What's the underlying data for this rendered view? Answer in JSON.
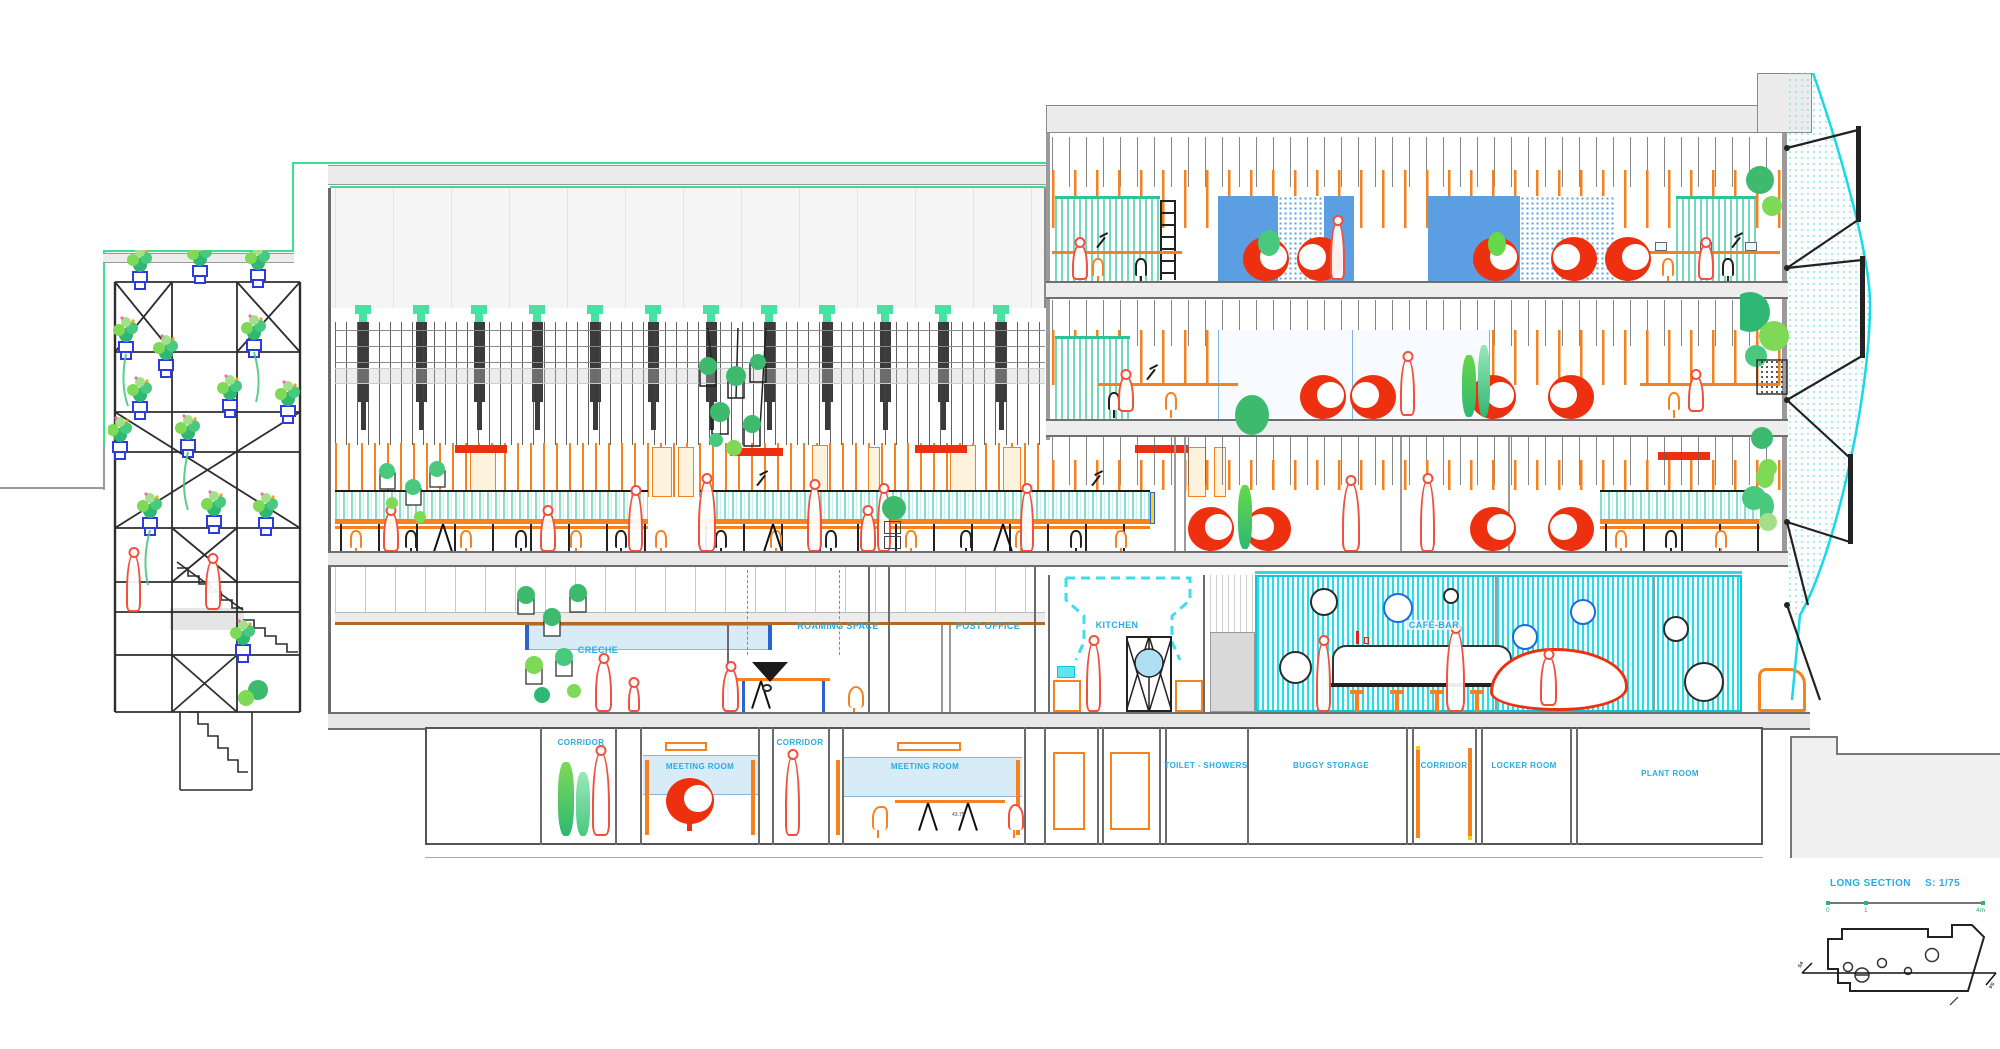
{
  "drawing": {
    "sheet_label": "LONG SECTION",
    "sheet_scale": "S: 1/75",
    "scale_bar_ticks": [
      "0",
      "1",
      "4m"
    ],
    "section_marker": "S4",
    "table_dimension_note": "43.75"
  },
  "rooms": {
    "ground_floor": [
      {
        "label": "CRECHE"
      },
      {
        "label": "ROAMING SPACE"
      },
      {
        "label": "POST OFFICE"
      },
      {
        "label": "KITCHEN"
      },
      {
        "label": "CAFÉ-BAR"
      }
    ],
    "basement": [
      {
        "label": "CORRIDOR"
      },
      {
        "label": "MEETING ROOM"
      },
      {
        "label": "CORRIDOR"
      },
      {
        "label": "MEETING ROOM"
      },
      {
        "label": "TOILET - SHOWERS"
      },
      {
        "label": "BUGGY STORAGE"
      },
      {
        "label": "CORRIDOR"
      },
      {
        "label": "LOCKER ROOM"
      },
      {
        "label": "PLANT ROOM"
      }
    ]
  },
  "colors": {
    "label_blue": "#29ABE2",
    "cyan": "#2BD9E8",
    "mint_green": "#3BE08F",
    "orange": "#F6821F",
    "signal_red": "#ED3110",
    "panel_blue": "#5B9FE2",
    "figure_red": "#F0503C",
    "plant_green": "#3DBA6E",
    "pot_blue": "#2B3BE0"
  }
}
